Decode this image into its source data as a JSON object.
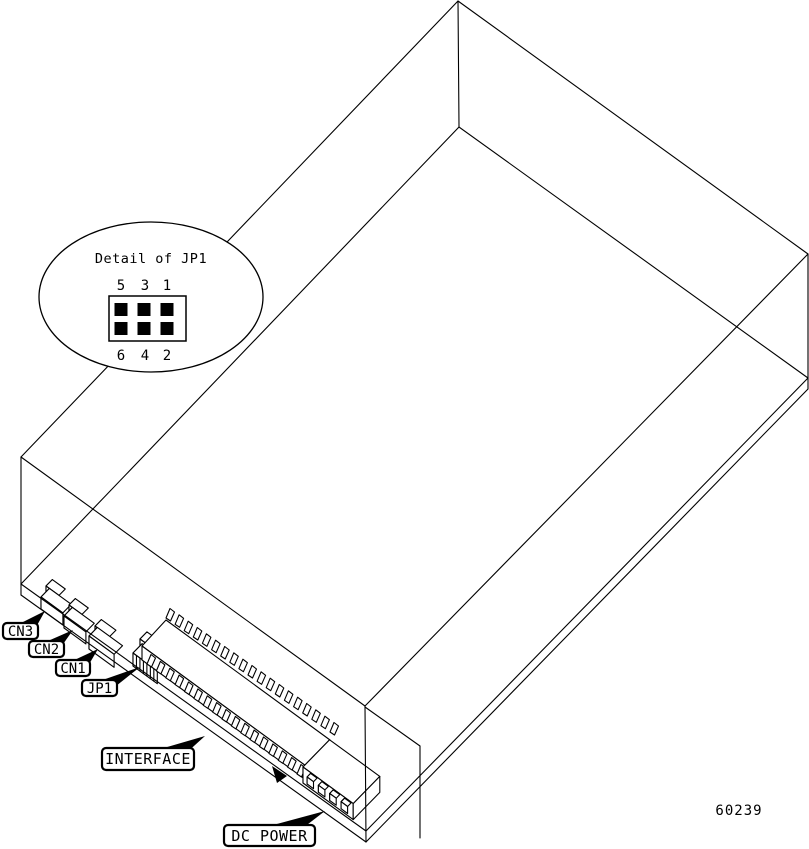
{
  "figure": {
    "id_number": "60239",
    "detail_callout": {
      "title": "Detail of JP1",
      "top_pins": [
        "5",
        "3",
        "1"
      ],
      "bottom_pins": [
        "6",
        "4",
        "2"
      ]
    },
    "connector_labels": {
      "cn3": "CN3",
      "cn2": "CN2",
      "cn1": "CN1",
      "jp1": "JP1",
      "interface": "INTERFACE",
      "dc_power": "DC POWER"
    },
    "colors": {
      "line": "#000000",
      "background": "#ffffff"
    }
  }
}
